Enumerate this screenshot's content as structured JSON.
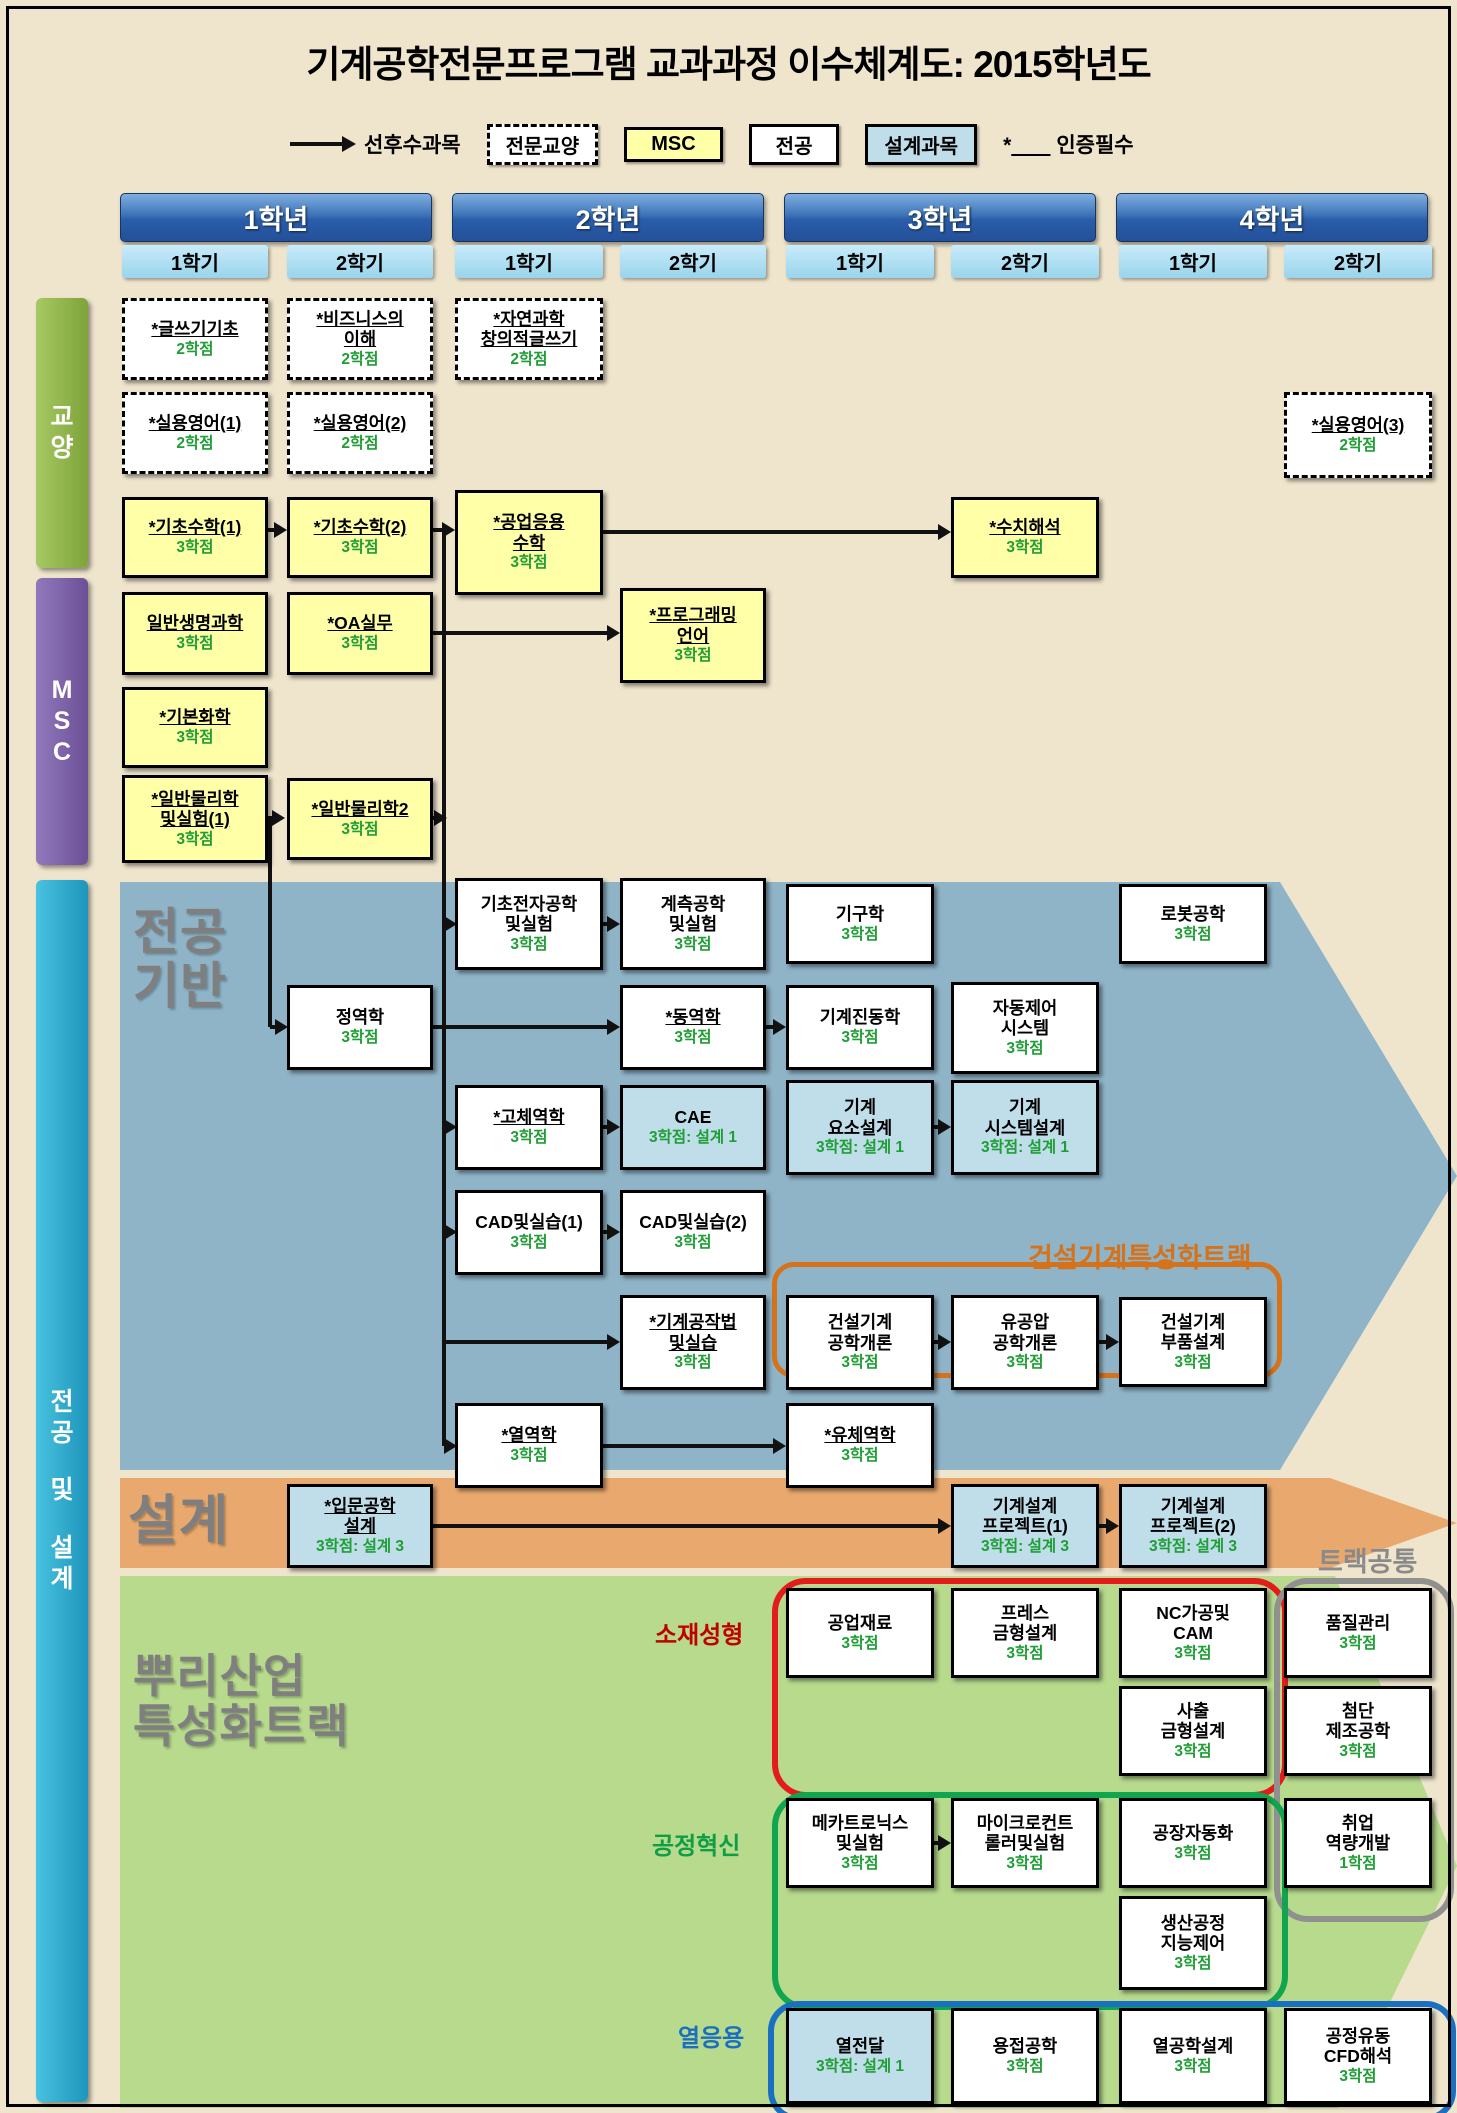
{
  "title": "기계공학전문프로그램 교과과정 이수체계도: 2015학년도",
  "legend": {
    "prereq_label": "선후수과목",
    "items": [
      {
        "label": "전문교양",
        "type": "dashed"
      },
      {
        "label": "MSC",
        "type": "msc"
      },
      {
        "label": "전공",
        "type": "major"
      },
      {
        "label": "설계과목",
        "type": "design"
      }
    ],
    "cert_label": "인증필수",
    "cert_prefix": "*"
  },
  "years": [
    {
      "label": "1학년",
      "x": 120,
      "w": 310,
      "semesters": [
        {
          "label": "1학기",
          "x": 122,
          "w": 146
        },
        {
          "label": "2학기",
          "x": 287,
          "w": 146
        }
      ]
    },
    {
      "label": "2학년",
      "x": 452,
      "w": 310,
      "semesters": [
        {
          "label": "1학기",
          "x": 455,
          "w": 148
        },
        {
          "label": "2학기",
          "x": 620,
          "w": 146
        }
      ]
    },
    {
      "label": "3학년",
      "x": 784,
      "w": 310,
      "semesters": [
        {
          "label": "1학기",
          "x": 786,
          "w": 148
        },
        {
          "label": "2학기",
          "x": 951,
          "w": 148
        }
      ]
    },
    {
      "label": "4학년",
      "x": 1116,
      "w": 310,
      "semesters": [
        {
          "label": "1학기",
          "x": 1119,
          "w": 148
        },
        {
          "label": "2학기",
          "x": 1284,
          "w": 148
        }
      ]
    }
  ],
  "sidebars": [
    {
      "id": "ky",
      "chars": [
        "교",
        "양"
      ]
    },
    {
      "id": "msc",
      "chars": [
        "M",
        "S",
        "C"
      ]
    },
    {
      "id": "mj",
      "chars": [
        "전",
        "공",
        "",
        "및",
        "",
        "설",
        "계"
      ]
    }
  ],
  "section_labels": [
    {
      "id": "major-base",
      "lines": [
        "전공",
        "기반"
      ],
      "x": 133,
      "y": 905,
      "size": 50
    },
    {
      "id": "design",
      "lines": [
        "설계"
      ],
      "x": 128,
      "y": 1492,
      "size": 54
    },
    {
      "id": "root-track",
      "lines": [
        "뿌리산업",
        "특성화트랙"
      ],
      "x": 133,
      "y": 1652,
      "size": 46
    }
  ],
  "track_labels": [
    {
      "id": "construction-track",
      "text": "건설기계특성화트랙",
      "x": 1028,
      "y": 1236,
      "size": 27,
      "color": "#D4731C"
    },
    {
      "id": "track-common",
      "text": "트랙공통",
      "x": 1318,
      "y": 1540,
      "size": 27,
      "color": "#8A8A8A"
    },
    {
      "id": "material-forming",
      "text": "소재성형",
      "x": 655,
      "y": 1615,
      "size": 24,
      "color": "#C00000"
    },
    {
      "id": "process-innovation",
      "text": "공정혁신",
      "x": 652,
      "y": 1826,
      "size": 24,
      "color": "#0F9D45"
    },
    {
      "id": "thermal-application",
      "text": "열응용",
      "x": 678,
      "y": 2018,
      "size": 24,
      "color": "#1B6FC0"
    }
  ],
  "columns": {
    "c1": [
      122,
      146
    ],
    "c2": [
      287,
      146
    ],
    "c3": [
      455,
      148
    ],
    "c4": [
      620,
      146
    ],
    "c5": [
      786,
      148
    ],
    "c6": [
      951,
      148
    ],
    "c7": [
      1119,
      148
    ],
    "c8": [
      1284,
      148
    ]
  },
  "courses": [
    {
      "lines": [
        "*글쓰기기초"
      ],
      "credit": "2학점",
      "type": "dashed",
      "col": "c1",
      "y": 298,
      "h": 82,
      "u": true
    },
    {
      "lines": [
        "*비즈니스의",
        "이해"
      ],
      "credit": "2학점",
      "type": "dashed",
      "col": "c2",
      "y": 298,
      "h": 82,
      "u": true
    },
    {
      "lines": [
        "*자연과학",
        "창의적글쓰기"
      ],
      "credit": "2학점",
      "type": "dashed",
      "col": "c3",
      "y": 298,
      "h": 82,
      "u": true
    },
    {
      "lines": [
        "*실용영어(1)"
      ],
      "credit": "2학점",
      "type": "dashed",
      "col": "c1",
      "y": 392,
      "h": 82,
      "u": true
    },
    {
      "lines": [
        "*실용영어(2)"
      ],
      "credit": "2학점",
      "type": "dashed",
      "col": "c2",
      "y": 392,
      "h": 82,
      "u": true
    },
    {
      "lines": [
        "*실용영어(3)"
      ],
      "credit": "2학점",
      "type": "dashed",
      "col": "c8",
      "y": 392,
      "h": 86,
      "u": true
    },
    {
      "lines": [
        "*기초수학(1)"
      ],
      "credit": "3학점",
      "type": "msc",
      "col": "c1",
      "y": 497,
      "h": 81,
      "u": true
    },
    {
      "lines": [
        "*기초수학(2)"
      ],
      "credit": "3학점",
      "type": "msc",
      "col": "c2",
      "y": 497,
      "h": 81,
      "u": true
    },
    {
      "lines": [
        "*공업응용",
        "수학"
      ],
      "credit": "3학점",
      "type": "msc",
      "col": "c3",
      "y": 490,
      "h": 105,
      "u": true
    },
    {
      "lines": [
        "*수치해석"
      ],
      "credit": "3학점",
      "type": "msc",
      "col": "c6",
      "y": 497,
      "h": 81,
      "u": true
    },
    {
      "lines": [
        "일반생명과학"
      ],
      "credit": "3학점",
      "type": "msc",
      "col": "c1",
      "y": 592,
      "h": 83,
      "u": true
    },
    {
      "lines": [
        "*OA실무"
      ],
      "credit": "3학점",
      "type": "msc",
      "col": "c2",
      "y": 592,
      "h": 83,
      "u": true
    },
    {
      "lines": [
        "*프로그래밍",
        "언어"
      ],
      "credit": "3학점",
      "type": "msc",
      "col": "c4",
      "y": 588,
      "h": 95,
      "u": true
    },
    {
      "lines": [
        "*기본화학"
      ],
      "credit": "3학점",
      "type": "msc",
      "col": "c1",
      "y": 687,
      "h": 81,
      "u": true
    },
    {
      "lines": [
        "*일반물리학",
        "및실험(1)"
      ],
      "credit": "3학점",
      "type": "msc",
      "col": "c1",
      "y": 775,
      "h": 88,
      "u": true
    },
    {
      "lines": [
        "*일반물리학2"
      ],
      "credit": "3학점",
      "type": "msc",
      "col": "c2",
      "y": 778,
      "h": 82,
      "u": true
    },
    {
      "lines": [
        "기초전자공학",
        "및실험"
      ],
      "credit": "3학점",
      "type": "major",
      "col": "c3",
      "y": 878,
      "h": 92,
      "u": false
    },
    {
      "lines": [
        "계측공학",
        "및실험"
      ],
      "credit": "3학점",
      "type": "major",
      "col": "c4",
      "y": 878,
      "h": 92,
      "u": false
    },
    {
      "lines": [
        "기구학"
      ],
      "credit": "3학점",
      "type": "major",
      "col": "c5",
      "y": 884,
      "h": 80,
      "u": false
    },
    {
      "lines": [
        "로봇공학"
      ],
      "credit": "3학점",
      "type": "major",
      "col": "c7",
      "y": 884,
      "h": 80,
      "u": false
    },
    {
      "lines": [
        "정역학"
      ],
      "credit": "3학점",
      "type": "major",
      "col": "c2",
      "y": 985,
      "h": 85,
      "u": false
    },
    {
      "lines": [
        "*동역학"
      ],
      "credit": "3학점",
      "type": "major",
      "col": "c4",
      "y": 985,
      "h": 85,
      "u": true
    },
    {
      "lines": [
        "기계진동학"
      ],
      "credit": "3학점",
      "type": "major",
      "col": "c5",
      "y": 985,
      "h": 85,
      "u": false
    },
    {
      "lines": [
        "자동제어",
        "시스템"
      ],
      "credit": "3학점",
      "type": "major",
      "col": "c6",
      "y": 982,
      "h": 92,
      "u": false
    },
    {
      "lines": [
        "*고체역학"
      ],
      "credit": "3학점",
      "type": "major",
      "col": "c3",
      "y": 1085,
      "h": 85,
      "u": true
    },
    {
      "lines": [
        "CAE"
      ],
      "credit": "3학점: 설계 1",
      "type": "design",
      "col": "c4",
      "y": 1085,
      "h": 85,
      "u": false
    },
    {
      "lines": [
        "기계",
        "요소설계"
      ],
      "credit": "3학점: 설계 1",
      "type": "design",
      "col": "c5",
      "y": 1080,
      "h": 95,
      "u": false
    },
    {
      "lines": [
        "기계",
        "시스템설계"
      ],
      "credit": "3학점: 설계 1",
      "type": "design",
      "col": "c6",
      "y": 1080,
      "h": 95,
      "u": false
    },
    {
      "lines": [
        "CAD및실습(1)"
      ],
      "credit": "3학점",
      "type": "major",
      "col": "c3",
      "y": 1190,
      "h": 85,
      "u": false
    },
    {
      "lines": [
        "CAD및실습(2)"
      ],
      "credit": "3학점",
      "type": "major",
      "col": "c4",
      "y": 1190,
      "h": 85,
      "u": false
    },
    {
      "lines": [
        "*기계공작법",
        "및실습"
      ],
      "credit": "3학점",
      "type": "major",
      "col": "c4",
      "y": 1295,
      "h": 95,
      "u": true
    },
    {
      "lines": [
        "건설기계",
        "공학개론"
      ],
      "credit": "3학점",
      "type": "major",
      "col": "c5",
      "y": 1295,
      "h": 95,
      "u": false
    },
    {
      "lines": [
        "유공압",
        "공학개론"
      ],
      "credit": "3학점",
      "type": "major",
      "col": "c6",
      "y": 1295,
      "h": 95,
      "u": false
    },
    {
      "lines": [
        "건설기계",
        "부품설계"
      ],
      "credit": "3학점",
      "type": "major",
      "col": "c7",
      "y": 1297,
      "h": 90,
      "u": false
    },
    {
      "lines": [
        "*열역학"
      ],
      "credit": "3학점",
      "type": "major",
      "col": "c3",
      "y": 1403,
      "h": 85,
      "u": true
    },
    {
      "lines": [
        "*유체역학"
      ],
      "credit": "3학점",
      "type": "major",
      "col": "c5",
      "y": 1403,
      "h": 85,
      "u": true
    },
    {
      "lines": [
        "*입문공학",
        "설계"
      ],
      "credit": "3학점: 설계 3",
      "type": "design",
      "col": "c2",
      "y": 1484,
      "h": 84,
      "u": true
    },
    {
      "lines": [
        "기계설계",
        "프로젝트(1)"
      ],
      "credit": "3학점: 설계 3",
      "type": "design",
      "col": "c6",
      "y": 1484,
      "h": 84,
      "u": false
    },
    {
      "lines": [
        "기계설계",
        "프로젝트(2)"
      ],
      "credit": "3학점: 설계 3",
      "type": "design",
      "col": "c7",
      "y": 1484,
      "h": 84,
      "u": false
    },
    {
      "lines": [
        "공업재료"
      ],
      "credit": "3학점",
      "type": "major",
      "col": "c5",
      "y": 1588,
      "h": 90,
      "u": false
    },
    {
      "lines": [
        "프레스",
        "금형설계"
      ],
      "credit": "3학점",
      "type": "major",
      "col": "c6",
      "y": 1588,
      "h": 90,
      "u": false
    },
    {
      "lines": [
        "NC가공및",
        "CAM"
      ],
      "credit": "3학점",
      "type": "major",
      "col": "c7",
      "y": 1588,
      "h": 90,
      "u": false
    },
    {
      "lines": [
        "품질관리"
      ],
      "credit": "3학점",
      "type": "major",
      "col": "c8",
      "y": 1588,
      "h": 90,
      "u": false
    },
    {
      "lines": [
        "사출",
        "금형설계"
      ],
      "credit": "3학점",
      "type": "major",
      "col": "c7",
      "y": 1686,
      "h": 90,
      "u": false
    },
    {
      "lines": [
        "첨단",
        "제조공학"
      ],
      "credit": "3학점",
      "type": "major",
      "col": "c8",
      "y": 1686,
      "h": 90,
      "u": false
    },
    {
      "lines": [
        "메카트로닉스",
        "및실험"
      ],
      "credit": "3학점",
      "type": "major",
      "col": "c5",
      "y": 1798,
      "h": 90,
      "u": false
    },
    {
      "lines": [
        "마이크로컨트",
        "롤러및실험"
      ],
      "credit": "3학점",
      "type": "major",
      "col": "c6",
      "y": 1798,
      "h": 90,
      "u": false
    },
    {
      "lines": [
        "공장자동화"
      ],
      "credit": "3학점",
      "type": "major",
      "col": "c7",
      "y": 1798,
      "h": 90,
      "u": false
    },
    {
      "lines": [
        "취업",
        "역량개발"
      ],
      "credit": "1학점",
      "type": "major",
      "col": "c8",
      "y": 1798,
      "h": 90,
      "u": false
    },
    {
      "lines": [
        "생산공정",
        "지능제어"
      ],
      "credit": "3학점",
      "type": "major",
      "col": "c7",
      "y": 1896,
      "h": 94,
      "u": false
    },
    {
      "lines": [
        "열전달"
      ],
      "credit": "3학점: 설계 1",
      "type": "design",
      "col": "c5",
      "y": 2008,
      "h": 96,
      "u": false
    },
    {
      "lines": [
        "용접공학"
      ],
      "credit": "3학점",
      "type": "major",
      "col": "c6",
      "y": 2008,
      "h": 96,
      "u": false
    },
    {
      "lines": [
        "열공학설계"
      ],
      "credit": "3학점",
      "type": "major",
      "col": "c7",
      "y": 2008,
      "h": 96,
      "u": false
    },
    {
      "lines": [
        "공정유동",
        "CFD해석"
      ],
      "credit": "3학점",
      "type": "major",
      "col": "c8",
      "y": 2008,
      "h": 96,
      "u": false
    }
  ],
  "groups": [
    {
      "id": "construction-group",
      "x": 772,
      "y": 1262,
      "w": 500,
      "h": 106,
      "color": "#D4731C",
      "bw": 5,
      "r": 22
    },
    {
      "id": "material-forming-group",
      "x": 772,
      "y": 1578,
      "w": 504,
      "h": 208,
      "color": "#E31B1B",
      "bw": 6,
      "r": 34
    },
    {
      "id": "track-common-group",
      "x": 1274,
      "y": 1578,
      "w": 168,
      "h": 332,
      "color": "#909090",
      "bw": 6,
      "r": 34
    },
    {
      "id": "process-innovation-group",
      "x": 772,
      "y": 1792,
      "w": 504,
      "h": 206,
      "color": "#12A550",
      "bw": 6,
      "r": 34
    },
    {
      "id": "thermal-group",
      "x": 768,
      "y": 2001,
      "w": 676,
      "h": 108,
      "color": "#1B6FC0",
      "bw": 6,
      "r": 30
    }
  ],
  "connectors": {
    "vlines": [
      {
        "x": 444,
        "y1": 532,
        "y2": 1446
      },
      {
        "x": 270,
        "y1": 818,
        "y2": 1027
      }
    ],
    "harrows": [
      {
        "x1": 263,
        "y": 530,
        "x2": 287
      },
      {
        "x1": 430,
        "y": 530,
        "x2": 455
      },
      {
        "x1": 601,
        "y": 532,
        "x2": 951
      },
      {
        "x1": 430,
        "y": 633,
        "x2": 620
      },
      {
        "x1": 263,
        "y": 818,
        "x2": 285
      },
      {
        "x1": 426,
        "y": 818,
        "x2": 447
      },
      {
        "x1": 444,
        "y": 924,
        "x2": 457
      },
      {
        "x1": 444,
        "y": 1127,
        "x2": 457
      },
      {
        "x1": 444,
        "y": 1232,
        "x2": 457
      },
      {
        "x1": 444,
        "y": 1446,
        "x2": 457
      },
      {
        "x1": 444,
        "y": 1342,
        "x2": 620
      },
      {
        "x1": 270,
        "y": 1027,
        "x2": 288
      },
      {
        "x1": 601,
        "y": 924,
        "x2": 620
      },
      {
        "x1": 433,
        "y": 1027,
        "x2": 620
      },
      {
        "x1": 766,
        "y": 1027,
        "x2": 786
      },
      {
        "x1": 601,
        "y": 1127,
        "x2": 620
      },
      {
        "x1": 934,
        "y": 1127,
        "x2": 951
      },
      {
        "x1": 601,
        "y": 1232,
        "x2": 620
      },
      {
        "x1": 934,
        "y": 1342,
        "x2": 951
      },
      {
        "x1": 1097,
        "y": 1342,
        "x2": 1119
      },
      {
        "x1": 601,
        "y": 1446,
        "x2": 786
      },
      {
        "x1": 433,
        "y": 1526,
        "x2": 951
      },
      {
        "x1": 1097,
        "y": 1526,
        "x2": 1119
      },
      {
        "x1": 934,
        "y": 1843,
        "x2": 951
      }
    ]
  }
}
